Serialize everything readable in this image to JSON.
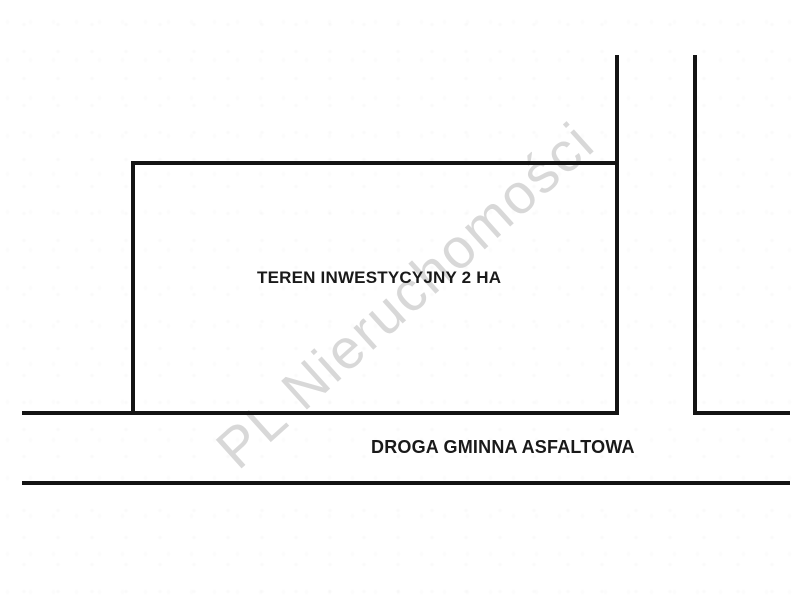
{
  "diagram": {
    "parcel": {
      "label": "TEREN INWESTYCYJNY 2 HA"
    },
    "road": {
      "label": "DROGA GMINNA ASFALTOWA"
    },
    "watermark": {
      "text": "PL Nieruchomości",
      "color": "#d8d8d8"
    },
    "colors": {
      "line": "#141414",
      "background": "#ffffff",
      "label_text": "#1a1a1a"
    }
  }
}
